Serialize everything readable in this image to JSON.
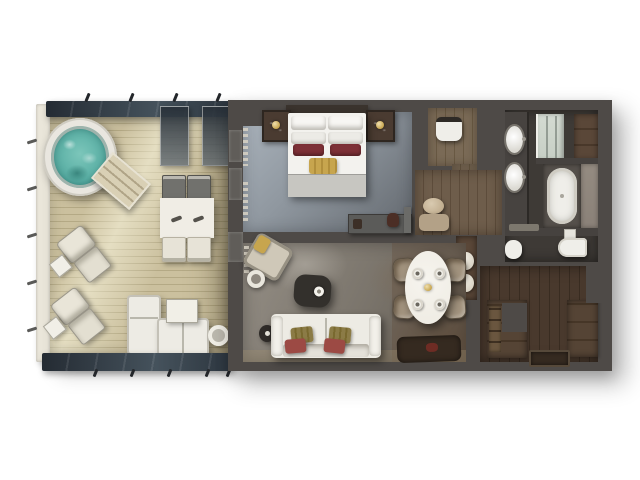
{
  "palette": {
    "wall": "#4e4a47",
    "deck": "#cbc09e",
    "railing": "#ebe7db",
    "railTan": "#b5a57f",
    "awningDark": "#242b33",
    "awningLight": "#45525c",
    "water": "#4ea79d",
    "tubRim": "#e9e6df",
    "carpetLight": "#aab3bc",
    "carpetDark": "#63686e",
    "bedWhite": "#f3f2ee",
    "bedFoot": "#c7c6c1",
    "pillowRed": "#7d3036",
    "pillowGold": "#c7a54e",
    "headboard": "#3a332d",
    "nightstand": "#4a3b31",
    "woodWc": "#7a6a56",
    "woodCorr": "#6e5d4b",
    "woodHall": "#49392d",
    "bathFloor": "#3e3a36",
    "fixture": "#efeee9",
    "shower": "#c7cfc5",
    "closet": "#5a4738",
    "marble": "#8a8178",
    "livingLight": "#948e85",
    "livingDark": "#5f584f",
    "sofaWhite": "#edebe4",
    "pillowOlive": "#8b7b46",
    "tableWhite": "#f0ede5",
    "wicker": "#a3947f",
    "rugDark": "#352a20",
    "accentRed": "#9c4a44",
    "darkTable": "#33302c",
    "towel": "#d8d2c4"
  },
  "floorplan": {
    "type": "suite-floor-plan-top-view",
    "rooms": [
      {
        "id": "balcony",
        "furniture": [
          "hot-tub",
          "hot-tub-steps",
          "outdoor-dining-table",
          "outdoor-dining-chairs",
          "lounge-chairs",
          "outdoor-sofa",
          "outdoor-side-tables",
          "railing",
          "awnings",
          "privacy-panels"
        ]
      },
      {
        "id": "bedroom",
        "furniture": [
          "king-bed",
          "nightstands",
          "table-lamps",
          "console",
          "curtains"
        ]
      },
      {
        "id": "water-closet",
        "furniture": [
          "toilet"
        ]
      },
      {
        "id": "dressing-corridor",
        "furniture": [
          "vanity-stool",
          "vanity-desk"
        ]
      },
      {
        "id": "bathroom",
        "furniture": [
          "double-sink-vanity",
          "shower",
          "bathtub",
          "toilet",
          "bidet",
          "linen-closet",
          "bath-mat"
        ]
      },
      {
        "id": "living-room",
        "furniture": [
          "sofa",
          "throw-pillows",
          "coffee-table",
          "armchair",
          "round-side-table",
          "floor-lamp",
          "dining-table",
          "dining-chairs",
          "place-settings",
          "dark-rug",
          "curtains"
        ]
      },
      {
        "id": "entry-hall",
        "furniture": [
          "wardrobe-left",
          "wardrobe-right",
          "towel-niche",
          "entry-mat"
        ]
      }
    ]
  }
}
